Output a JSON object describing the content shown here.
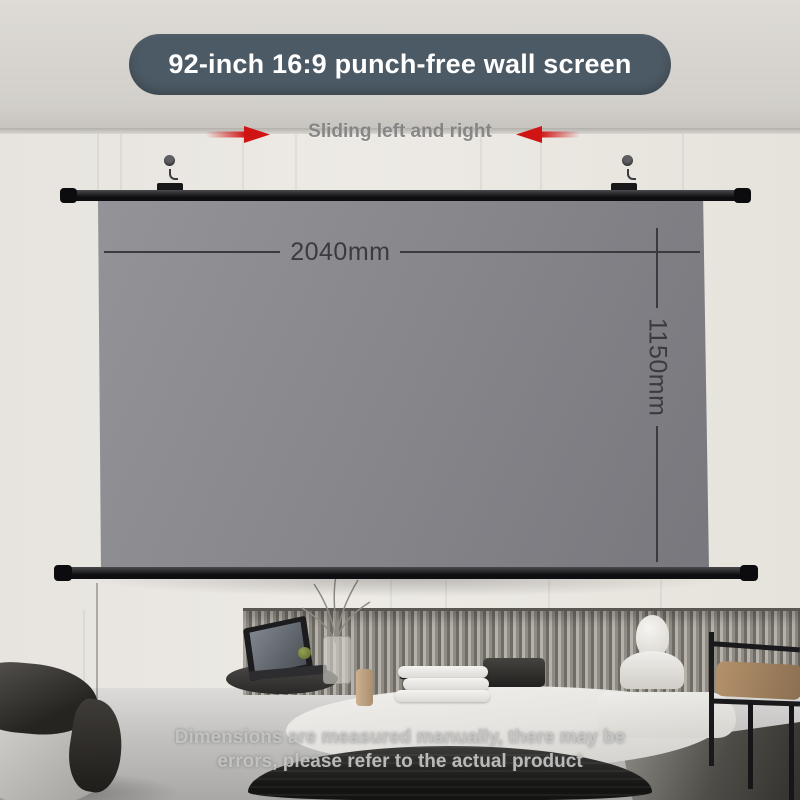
{
  "banner": {
    "title": "92-inch 16:9 punch-free wall screen",
    "bg_color": "#4c5a65",
    "text_color": "#ffffff"
  },
  "sliding_annotation": {
    "label": "Sliding left and right",
    "label_color": "#7a7a7a",
    "arrow_color": "#d01414"
  },
  "dimensions": {
    "width_label": "2040mm",
    "height_label": "1150mm",
    "line_color": "#3b3b3f"
  },
  "screen": {
    "surface_color": "#86868b",
    "rail_color": "#141416"
  },
  "disclaimer": {
    "text": "Dimensions are measured manually, there may be errors, please refer to the actual product",
    "color": "#c6c6c6"
  }
}
